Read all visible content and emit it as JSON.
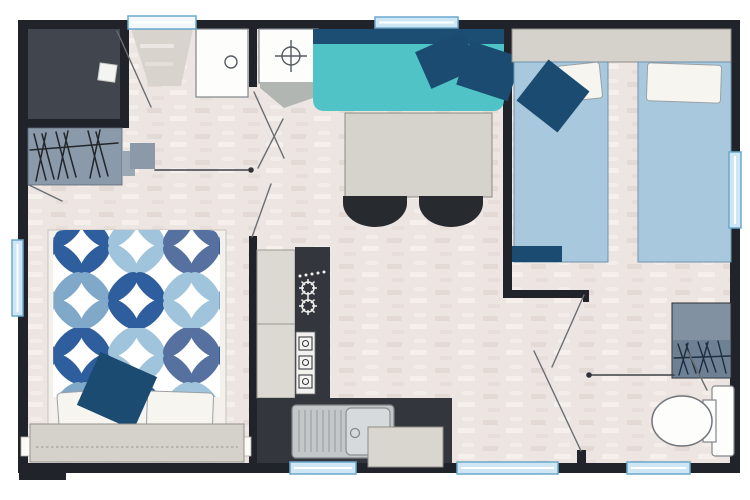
{
  "plan": {
    "type": "mobile-home-floor-plan",
    "fixtures": [
      "shower-room",
      "shower-tray",
      "wardrobe-left",
      "entrance-door",
      "doormat",
      "bathroom-cabinet",
      "washbasin",
      "corner-sofa",
      "sofa-cushions",
      "dining-table",
      "dining-chairs",
      "twin-bed-left",
      "twin-bed-right",
      "twin-headboard",
      "pillows",
      "double-bed",
      "double-bed-duvet",
      "double-bed-headboard",
      "kitchen-cabinet-column",
      "kitchen-counter",
      "gas-hob",
      "appliance-column",
      "kitchen-sink",
      "worktop-appliance",
      "wardrobe-right",
      "toilet",
      "windows",
      "door-swings",
      "sliding-door-tracks"
    ]
  },
  "colors": {
    "background": "#ffffff",
    "wall": "#20242a",
    "floor_base": "#ece5e1",
    "floor_dash_dark": "#dccfcb",
    "floor_dash_light": "#f7f2ef",
    "shower_room": "#41464e",
    "shower_tray": "#f4f4f2",
    "wardrobe_left": "#8b9aab",
    "wardrobe_tab": "#9aa7b5",
    "wardrobe_right_top": "#8191a2",
    "wardrobe_right_bottom": "#6e8093",
    "sofa_seat": "#4fc3c6",
    "sofa_back": "#1c4e74",
    "cushion_navy": "#1b4b70",
    "twin_bed": "#a8c9dd",
    "pillow": "#f7f5f0",
    "headboard": "#d5d2cc",
    "table": "#d6d3cd",
    "chair": "#272b30",
    "kitchen_counter": "#33373d",
    "kitchen_cabinet": "#dcd9d3",
    "appliance_strip": "#f2f1ee",
    "sink_body": "#c3c7ca",
    "sink_bowl": "#d7dadd",
    "appliance_box": "#d9d6d0",
    "fixture_white": "#fdfdfb",
    "window_fill": "#cfe7f4",
    "door_leaf_fill": "#f2f8fc",
    "mat": "#d9d3cd",
    "shadow_wedge": "#b2b6b3",
    "slider_handle": "#8b99a8",
    "duvet_bg": "#ffffff",
    "duvet_c1": "#2e5e9d",
    "duvet_c2": "#9fc4db",
    "duvet_c3": "#56719f",
    "duvet_c4": "#7fa8c9"
  }
}
